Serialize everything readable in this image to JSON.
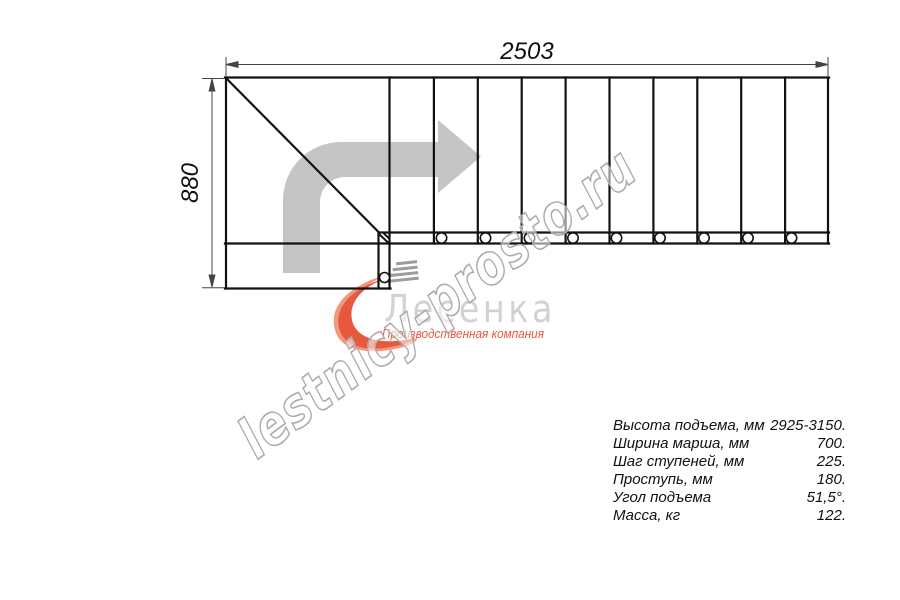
{
  "diagram": {
    "top_dimension_label": "2503",
    "left_dimension_label": "880",
    "steps_count": 10,
    "post_marker_count": 10
  },
  "watermark": {
    "text": "lestnicy-prosto.ru",
    "color": "#ababab"
  },
  "logo": {
    "name": "Лесенка",
    "subtitle": "Производственная компания",
    "accent_color": "#e8583c",
    "name_color": "#d2d2d2"
  },
  "specs": {
    "rows": [
      {
        "label": "Высота подъема, мм",
        "value": "2925-3150."
      },
      {
        "label": "Ширина марша, мм",
        "value": "700."
      },
      {
        "label": "Шаг ступеней, мм",
        "value": "225."
      },
      {
        "label": "Проступь, мм",
        "value": "180."
      },
      {
        "label": "Угол подъема",
        "value": "51,5°."
      },
      {
        "label": "Масса, кг",
        "value": "122."
      }
    ]
  },
  "colors": {
    "line": "#111111",
    "arrow": "#c5c5c5",
    "dimension": "#444444"
  }
}
